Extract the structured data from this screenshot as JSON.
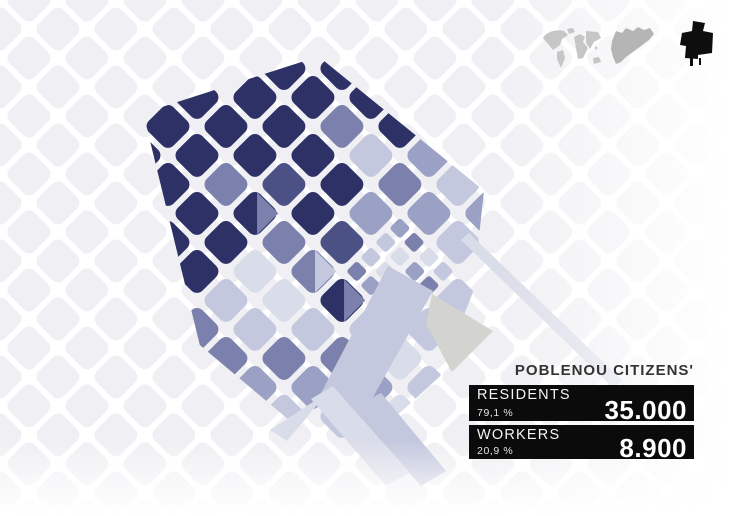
{
  "title_panel": {
    "title": "POBLENOU CITIZENS'",
    "items": [
      {
        "label": "RESIDENTS",
        "percent": "79,1 %",
        "value": "35.000"
      },
      {
        "label": "WORKERS",
        "percent": "20,9 %",
        "value": "8.900"
      }
    ]
  },
  "icons": {
    "world": {
      "label": "world-map",
      "color": "#c6c6c6"
    },
    "catalonia": {
      "label": "catalonia-region",
      "color": "#b5b5b5"
    },
    "district": {
      "label": "poblenou-district",
      "color": "#0e0e0e"
    }
  },
  "map": {
    "palette": {
      "1": "#2d3166",
      "2": "#4b5184",
      "3": "#7b81ac",
      "4": "#9ba1c4",
      "5": "#c4c8de",
      "6": "#d9dce9",
      "gray": "#d3d3cf",
      "street": "#ffffff",
      "faint_block": "#f0f0f4"
    },
    "grid": {
      "pitch": 41,
      "block_size": 35,
      "corner_radius": 8,
      "rotation_deg": -45,
      "center_x": 320,
      "center_y": 270,
      "origin_x": 150,
      "origin_y": 20
    },
    "district_polygon": "470,118 306,34 182,238 198,424 330,430 412,394 492,330",
    "block_rows": [
      "0000000000",
      "0001110000",
      "0001111100",
      "0011311110",
      "0011a21310",
      "0356311510",
      "0356b24340",
      "0435aqq450",
      "05435qq540",
      "0054655000",
      "0006500000"
    ],
    "special_shapes": [
      {
        "name": "rail-yard-wedge",
        "type": "path",
        "d": "M432,294 L493,331 L452,372 C442,355 437,342 426,325 Z",
        "color": "gray"
      },
      {
        "name": "avenue-band",
        "type": "polygon",
        "points": "388,266 433,291 360,420 319,397",
        "color": "5"
      },
      {
        "name": "avenue-strip-se",
        "type": "polygon",
        "points": "352,408 381,393 446,471 421,486",
        "color": "5"
      },
      {
        "name": "strip-se-2",
        "type": "polygon",
        "points": "311,399 333,386 409,473 386,486",
        "color": "6"
      },
      {
        "name": "strip-sw",
        "type": "polygon",
        "points": "316,400 331,388 287,441 270,430",
        "color": "6"
      },
      {
        "name": "coast-strip",
        "type": "polygon",
        "points": "461,240 469,233 623,381 613,388",
        "color": "6"
      }
    ]
  }
}
